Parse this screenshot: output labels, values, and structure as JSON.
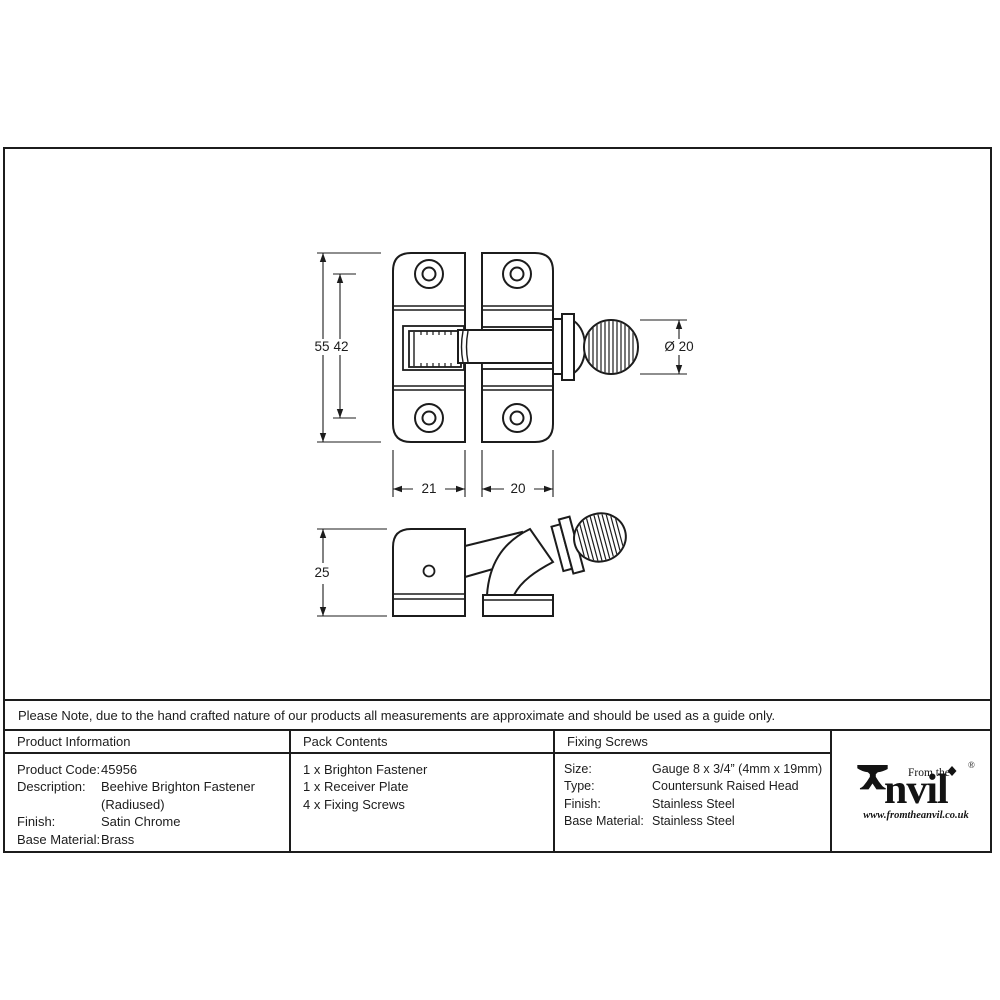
{
  "note": "Please Note, due to the hand crafted nature of our products all measurements are approximate and should be used as a guide only.",
  "drawing": {
    "dimensions": {
      "total_height": "55",
      "hole_spacing": "42",
      "knob_diameter": "Ø 20",
      "plate_width": "21",
      "keep_width": "20",
      "depth": "25"
    }
  },
  "table": {
    "product_information": {
      "header": "Product Information",
      "rows": [
        {
          "label": "Product Code:",
          "value": "45956"
        },
        {
          "label": "Description:",
          "value": "Beehive Brighton Fastener"
        },
        {
          "label": "",
          "value": "(Radiused)"
        },
        {
          "label": "Finish:",
          "value": "Satin Chrome"
        },
        {
          "label": "Base Material:",
          "value": "Brass"
        }
      ]
    },
    "pack_contents": {
      "header": "Pack Contents",
      "items": [
        "1 x Brighton Fastener",
        "1 x Receiver Plate",
        "4 x Fixing Screws"
      ]
    },
    "fixing_screws": {
      "header": "Fixing Screws",
      "rows": [
        {
          "label": "Size:",
          "value": "Gauge 8 x 3/4” (4mm x 19mm)"
        },
        {
          "label": "Type:",
          "value": "Countersunk Raised Head"
        },
        {
          "label": "Finish:",
          "value": "Stainless Steel"
        },
        {
          "label": "Base Material:",
          "value": "Stainless Steel"
        }
      ]
    }
  },
  "logo": {
    "tagline": "From the",
    "brand_suffix": "nvil",
    "registered": "®",
    "website": "www.fromtheanvil.co.uk"
  },
  "colors": {
    "line": "#1c1c1c",
    "background": "#ffffff"
  }
}
